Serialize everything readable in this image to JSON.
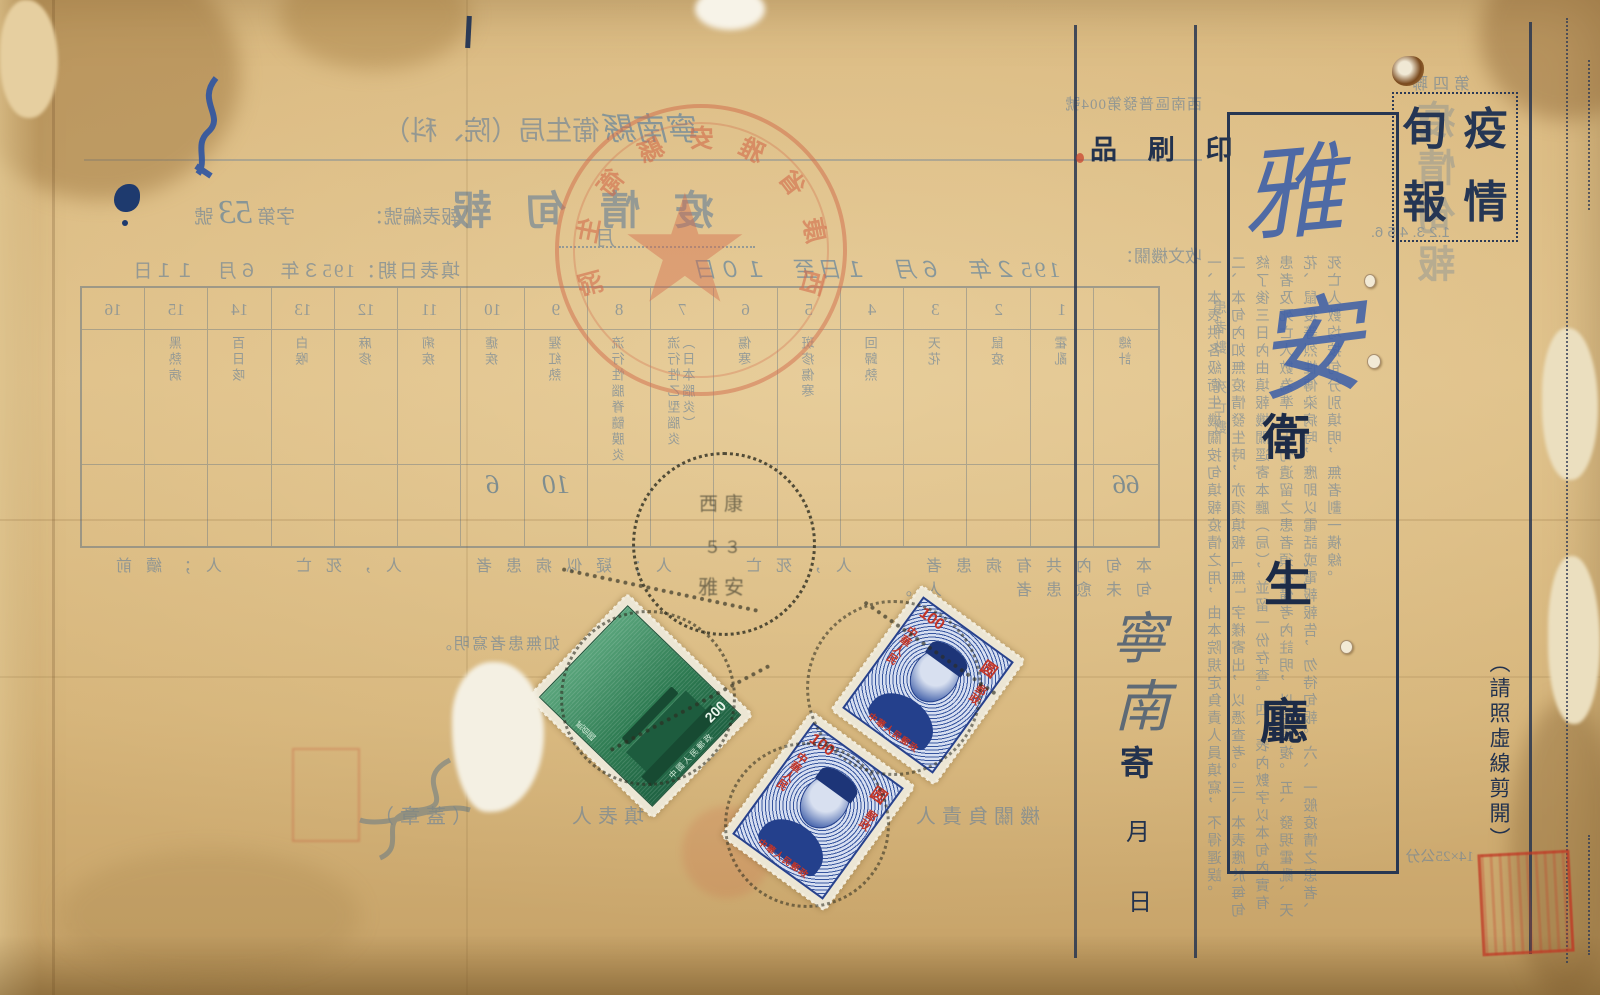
{
  "document_kind": "Scanned 1950s Chinese epidemic ten-day report form (postal side) with stamps and postmarks",
  "colors": {
    "paper": "#dcbc82",
    "recto_ink": "#22324e",
    "bleed_ink": "#6e8498",
    "handwriting_blue": "#3b5ea9",
    "handwriting_grey": "#5e6a76",
    "seal_red": "#c43e2b",
    "stamp_green": "#2e7b52",
    "stamp_blue": "#2c4c9c",
    "overprint_red": "#c33527",
    "postmark_black": "#2d2d21"
  },
  "recto": {
    "corner_box": {
      "chars": [
        "旬",
        "疫",
        "報",
        "情"
      ]
    },
    "printed_matter_label": "品 刷 印",
    "address_box": {
      "handwritten_place": [
        "雅",
        "安"
      ],
      "org_chars": [
        "衛",
        "生",
        "廳"
      ]
    },
    "sender_panel": {
      "handwritten_sender": [
        "寧",
        "南"
      ],
      "send_label": "寄",
      "month_label": "月",
      "day_label": "日"
    },
    "cut_note": "（請照虛線剪開）"
  },
  "bleed": {
    "copy_label": "第四聯",
    "vertical_title": "疫情旬報",
    "dispatch_no": "西南區普發第004號",
    "recv_label": "收文機關：",
    "dept_header_hw": "寧南縣",
    "dept_header_print": "衛生局（院、科）",
    "title": "疫 情 旬 報",
    "subtitle_month_label": "月",
    "serial": {
      "label": "報表編號：",
      "mid": "字第",
      "hw_no": "53",
      "suffix": "號"
    },
    "period": "195２年　６月　１日至　１０日",
    "filled_date": "填表日期：195３年　６月　１１日",
    "table": {
      "row_side_label": "患者數　死亡數",
      "cols": [
        {
          "num": "",
          "name": "總計",
          "entry": "66"
        },
        {
          "num": "1",
          "name": "霍亂",
          "entry": ""
        },
        {
          "num": "2",
          "name": "鼠疫",
          "entry": ""
        },
        {
          "num": "3",
          "name": "天花",
          "entry": ""
        },
        {
          "num": "4",
          "name": "回歸熱",
          "entry": ""
        },
        {
          "num": "5",
          "name": "斑疹傷寒",
          "entry": ""
        },
        {
          "num": "6",
          "name": "傷寒",
          "entry": ""
        },
        {
          "num": "7",
          "name": "流行性乙型腦炎（日本腦炎）",
          "entry": ""
        },
        {
          "num": "8",
          "name": "流行性腦脊髓膜炎",
          "entry": ""
        },
        {
          "num": "9",
          "name": "猩紅熱",
          "entry": "10"
        },
        {
          "num": "10",
          "name": "瘧疾",
          "entry": "6"
        },
        {
          "num": "11",
          "name": "痢疾",
          "entry": ""
        },
        {
          "num": "12",
          "name": "麻疹",
          "entry": ""
        },
        {
          "num": "13",
          "name": "白喉",
          "entry": ""
        },
        {
          "num": "14",
          "name": "百日咳",
          "entry": ""
        },
        {
          "num": "15",
          "name": "黑熱病",
          "entry": ""
        },
        {
          "num": "16",
          "name": "",
          "entry": ""
        }
      ]
    },
    "paragraph": "本旬內共有病患者　　人，死亡　　人；疑似病患者　　人，死亡　　人；續前旬未愈患者　　人。",
    "note": "如無患者寫明。",
    "signature_line": "機關負責人　　　（蓋章）　　　　填表人　　　　（蓋章）",
    "size_note": "14×25公分",
    "instructions_heading": "1.2 3. 4.5 6.",
    "instructions_text": "一、本表供各級衛生機關按旬填報疫情之用，由本院規定負責人員填寫，不得遲誤。二、本旬內如無疫情發生時，亦須填報「無」字樣寄出，以憑查考。三、本表應於每旬終了後三日內由填報機關逕寄本廳（局），並留一份存查。四、表內數字以本旬內實有患者及死亡人數為準，上旬遺留之患者須在備考內註明，以免重複。五、發現霍亂、天花、鼠疫等烈性傳染病時，應即以電話或電報報告，勿待旬報。六、一般疫情之患者、死亡人數均按旬分別填明，無者劃一橫線。",
    "official_seal": {
      "arc_chars": [
        "西",
        "康",
        "省",
        "雅",
        "安",
        "縣",
        "衛",
        "生",
        "院"
      ],
      "star": "★"
    }
  },
  "stamps": [
    {
      "design": "tiananmen-gate",
      "country": "中國人民郵政",
      "value_numeral": "200",
      "value_cn": "贰佰圆"
    },
    {
      "design": "sun-yat-sen-overprint",
      "overprint_top": "100",
      "overprint_unit": "圆",
      "overprint_left": "中華人民",
      "overprint_right": "郵政",
      "overprint_bottom": "中華人民郵政"
    },
    {
      "design": "sun-yat-sen-overprint",
      "overprint_top": "100",
      "overprint_unit": "圆",
      "overprint_left": "中華人民",
      "overprint_right": "郵政",
      "overprint_bottom": "中華人民郵政"
    }
  ],
  "postmarks": {
    "chars_top": "西康",
    "chars_bottom": "雅安",
    "digits": "５３"
  }
}
